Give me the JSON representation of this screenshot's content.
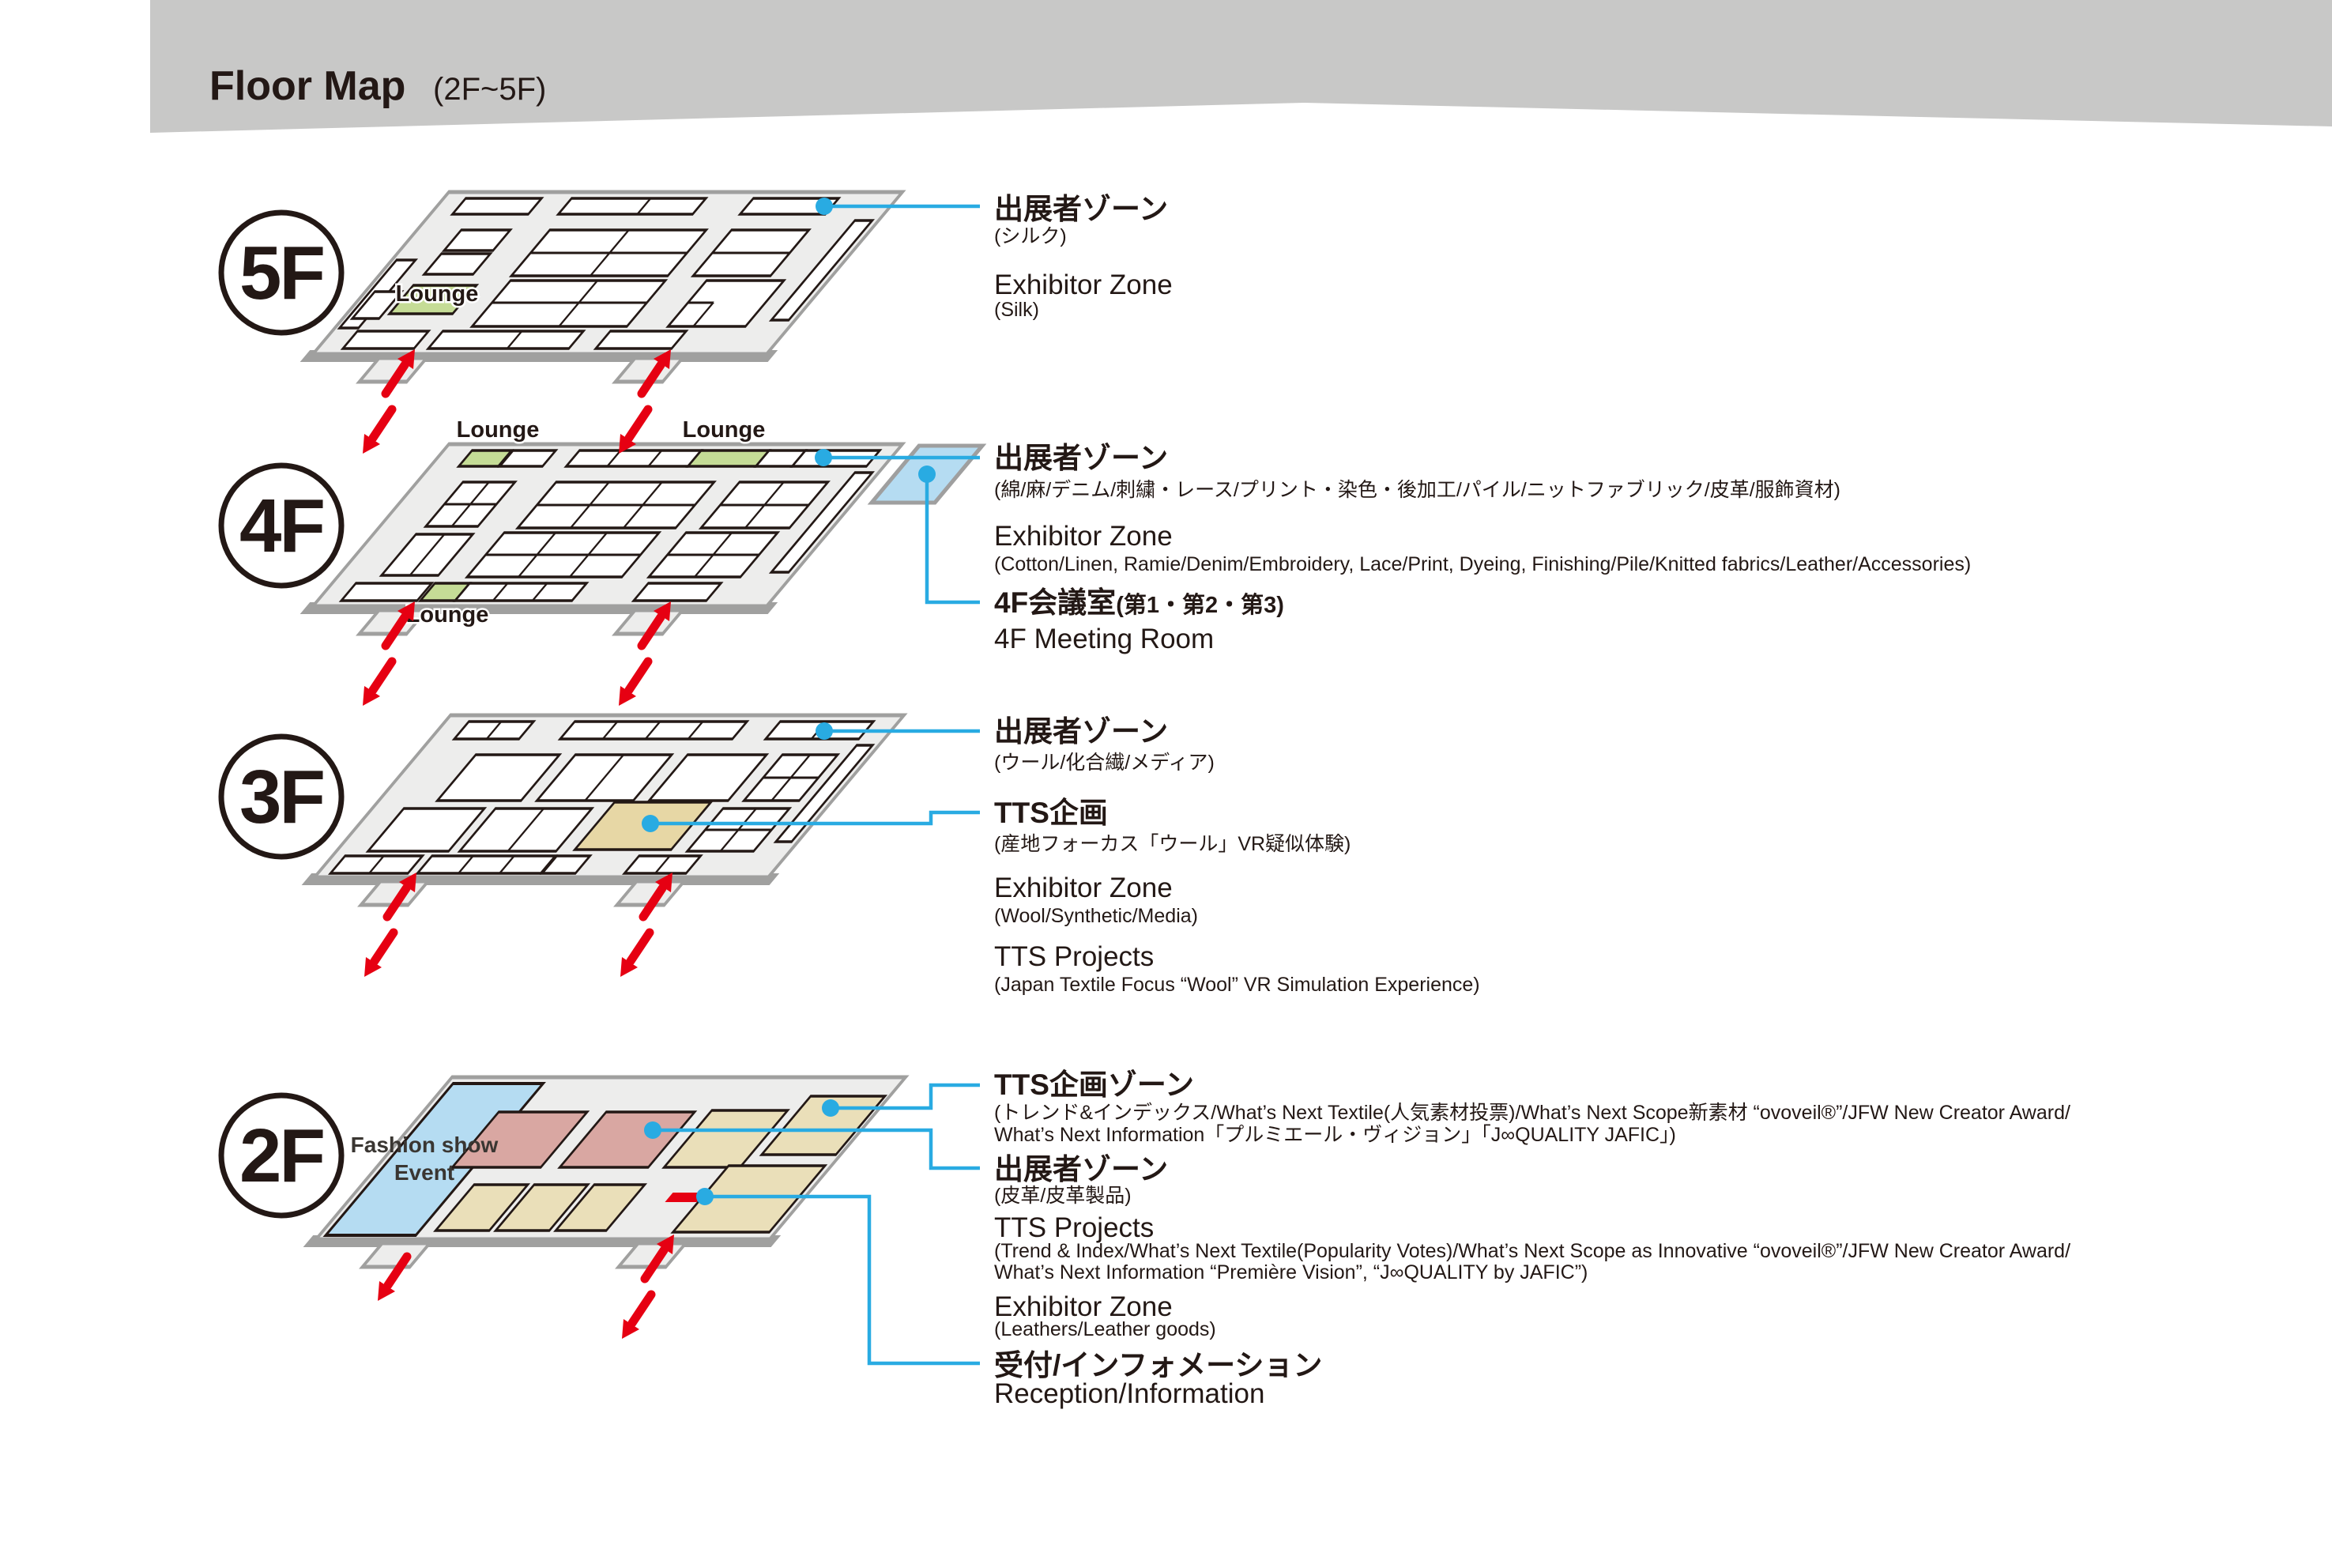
{
  "header": {
    "title": "Floor Map",
    "subtitle": "(2F~5F)"
  },
  "colors": {
    "header_gray": "#c8c8c7",
    "ink": "#231815",
    "accent_blue": "#29abe2",
    "escalator_red": "#e60012",
    "lounge_green": "#c5dc96",
    "fashion_event_blue": "#b5dcf2",
    "meeting_room_blue": "#b5dcf2",
    "booth_pink": "#d9a7a2",
    "booth_beige": "#eadfb9",
    "tts_booth_tan": "#e7d7a5",
    "floor_gray": "#ededec"
  },
  "icons": {
    "escalator": "red-double-arrow",
    "callout_marker": "blue-dot",
    "reception_marker": "red-bar"
  },
  "f5": {
    "badge": "5F",
    "lounge": "Lounge",
    "zone": {
      "jp": "出展者ゾーン",
      "jp_sub": "(シルク)",
      "en": "Exhibitor Zone",
      "en_sub": "(Silk)"
    }
  },
  "f4": {
    "badge": "4F",
    "lounge_top_left": "Lounge",
    "lounge_top_mid": "Lounge",
    "lounge_bottom": "Lounge",
    "zone": {
      "jp": "出展者ゾーン",
      "jp_sub": "(綿/麻/デニム/刺繍・レース/プリント・染色・後加工/パイル/ニットファブリック/皮革/服飾資材)",
      "en": "Exhibitor Zone",
      "en_sub": "(Cotton/Linen, Ramie/Denim/Embroidery, Lace/Print, Dyeing, Finishing/Pile/Knitted fabrics/Leather/Accessories)"
    },
    "meeting": {
      "jp": "4F会議室",
      "jp_paren": "(第1・第2・第3)",
      "en": "4F Meeting Room"
    }
  },
  "f3": {
    "badge": "3F",
    "zone": {
      "jp": "出展者ゾーン",
      "jp_sub": "(ウール/化合繊/メディア)",
      "en": "Exhibitor Zone",
      "en_sub": "(Wool/Synthetic/Media)"
    },
    "tts": {
      "jp": "TTS企画",
      "jp_sub": "(産地フォーカス「ウール」VR疑似体験)",
      "en": "TTS Projects",
      "en_sub": "(Japan Textile Focus “Wool” VR Simulation Experience)"
    }
  },
  "f2": {
    "badge": "2F",
    "fashion_line1": "Fashion show",
    "fashion_line2": "Event",
    "tts_zone": {
      "jp": "TTS企画ゾーン",
      "jp_sub1": "(トレンド&インデックス/What’s Next Textile(人気素材投票)/What’s Next Scope新素材 “ovoveil®”/JFW New Creator Award/",
      "jp_sub2": "What’s Next Information「プルミエール・ヴィジョン」「J∞QUALITY JAFIC」)"
    },
    "zone": {
      "jp": "出展者ゾーン",
      "jp_sub": "(皮革/皮革製品)"
    },
    "tts_projects": {
      "en": "TTS Projects",
      "en_sub1": "(Trend & Index/What’s Next Textile(Popularity Votes)/What’s Next Scope as Innovative “ovoveil®”/JFW New Creator Award/",
      "en_sub2": "What’s Next Information “Première Vision”, “J∞QUALITY by JAFIC”)"
    },
    "exhibitor": {
      "en": "Exhibitor Zone",
      "en_sub": "(Leathers/Leather goods)"
    },
    "reception": {
      "jp": "受付/インフォメーション",
      "en": "Reception/Information"
    }
  }
}
